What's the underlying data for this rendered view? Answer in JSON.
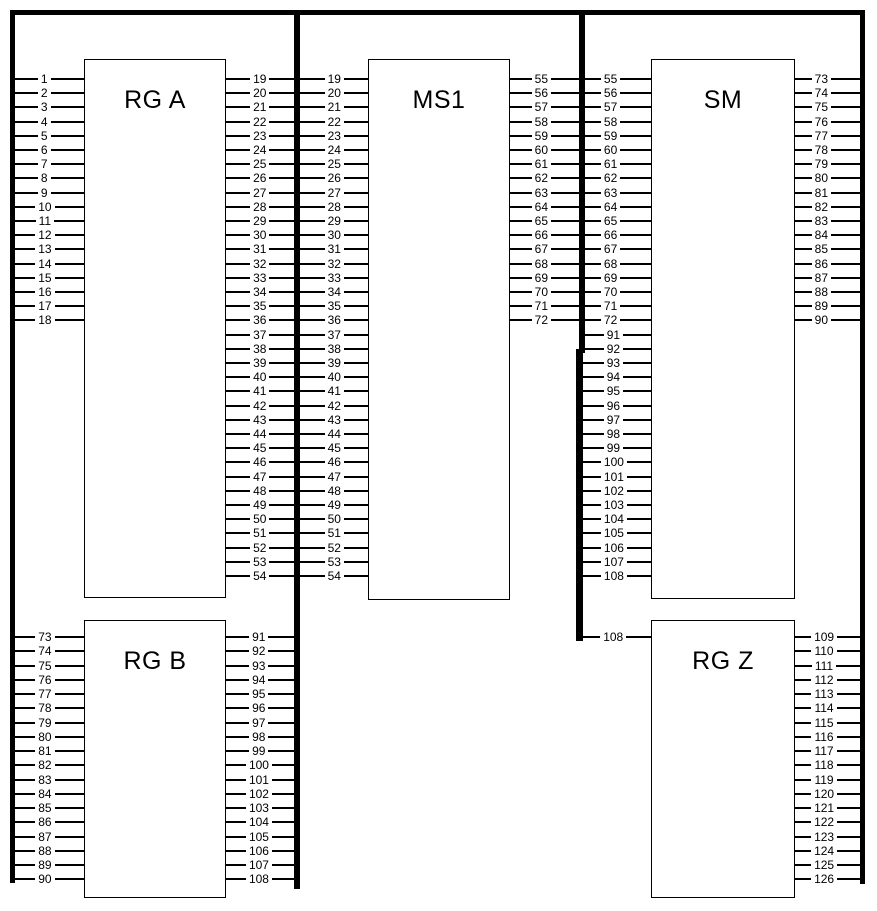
{
  "diagram": {
    "title": "terminal wiring diagram",
    "colors": {
      "line": "#000000",
      "background": "#ffffff"
    },
    "boxes": [
      {
        "id": "rg-a",
        "label": "RG A"
      },
      {
        "id": "ms1",
        "label": "MS1"
      },
      {
        "id": "sm",
        "label": "SM"
      },
      {
        "id": "rg-b",
        "label": "RG B"
      },
      {
        "id": "rg-z",
        "label": "RG Z"
      }
    ],
    "pin_groups": [
      {
        "name": "rg-a-left",
        "description": "left pins of RG A from left frame bar",
        "double_label": false,
        "pins": [
          "1",
          "2",
          "3",
          "4",
          "5",
          "6",
          "7",
          "8",
          "9",
          "10",
          "11",
          "12",
          "13",
          "14",
          "15",
          "16",
          "17",
          "18"
        ]
      },
      {
        "name": "rg-a-to-ms1",
        "description": "lines from RG A to MS1 crossing divider, numbered on both sides",
        "double_label": true,
        "pins": [
          "19",
          "20",
          "21",
          "22",
          "23",
          "24",
          "25",
          "26",
          "27",
          "28",
          "29",
          "30",
          "31",
          "32",
          "33",
          "34",
          "35",
          "36",
          "37",
          "38",
          "39",
          "40",
          "41",
          "42",
          "43",
          "44",
          "45",
          "46",
          "47",
          "48",
          "49",
          "50",
          "51",
          "52",
          "53",
          "54"
        ]
      },
      {
        "name": "ms1-to-sm",
        "description": "lines from MS1 to SM crossing divider, numbered on both sides",
        "double_label": true,
        "pins": [
          "55",
          "56",
          "57",
          "58",
          "59",
          "60",
          "61",
          "62",
          "63",
          "64",
          "65",
          "66",
          "67",
          "68",
          "69",
          "70",
          "71",
          "72"
        ]
      },
      {
        "name": "sm-left-lower",
        "description": "lower left pins of SM from divider bar",
        "double_label": false,
        "pins": [
          "91",
          "92",
          "93",
          "94",
          "95",
          "96",
          "97",
          "98",
          "99",
          "100",
          "101",
          "102",
          "103",
          "104",
          "105",
          "106",
          "107",
          "108"
        ]
      },
      {
        "name": "sm-right",
        "description": "right pins of SM to right frame bar",
        "double_label": false,
        "pins": [
          "73",
          "74",
          "75",
          "76",
          "77",
          "78",
          "79",
          "80",
          "81",
          "82",
          "83",
          "84",
          "85",
          "86",
          "87",
          "88",
          "89",
          "90"
        ]
      },
      {
        "name": "rg-b-left",
        "description": "left pins of RG B from left frame bar",
        "double_label": false,
        "pins": [
          "73",
          "74",
          "75",
          "76",
          "77",
          "78",
          "79",
          "80",
          "81",
          "82",
          "83",
          "84",
          "85",
          "86",
          "87",
          "88",
          "89",
          "90"
        ]
      },
      {
        "name": "rg-b-right",
        "description": "right pins of RG B to divider bar",
        "double_label": false,
        "pins": [
          "91",
          "92",
          "93",
          "94",
          "95",
          "96",
          "97",
          "98",
          "99",
          "100",
          "101",
          "102",
          "103",
          "104",
          "105",
          "106",
          "107",
          "108"
        ]
      },
      {
        "name": "rg-z-left",
        "description": "left pin of RG Z from divider bar stub",
        "double_label": false,
        "pins": [
          "108"
        ]
      },
      {
        "name": "rg-z-right",
        "description": "right pins of RG Z to right frame bar",
        "double_label": false,
        "pins": [
          "109",
          "110",
          "111",
          "112",
          "113",
          "114",
          "115",
          "116",
          "117",
          "118",
          "119",
          "120",
          "121",
          "122",
          "123",
          "124",
          "125",
          "126"
        ]
      }
    ]
  }
}
